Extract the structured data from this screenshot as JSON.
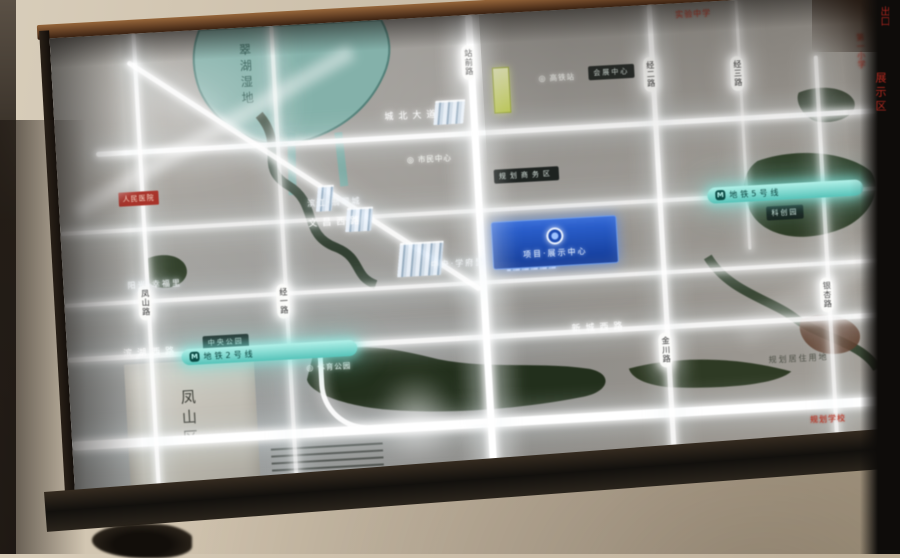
{
  "photo": {
    "description": "售楼处发光区位图灯箱照片",
    "wall_color": "#c8bba6",
    "frame_wood_color": "#6b4527"
  },
  "map": {
    "lake_label": "翠湖湿地",
    "district_label": "凤山区",
    "metro_lines": [
      {
        "icon": "M",
        "label": "地铁5号线"
      },
      {
        "icon": "M",
        "label": "地铁2号线"
      }
    ],
    "project_sign": {
      "logo": "",
      "name": "项目·展示中心"
    },
    "road_capsules": [
      "凤山路",
      "经一路",
      "站前路",
      "金川路",
      "经二路",
      "经三路",
      "银杏路"
    ],
    "road_names": [
      "文昌西路",
      "城北大道",
      "新城西路",
      "滨湖西路"
    ],
    "poi_labels": [
      {
        "icon": "◎",
        "text": "高铁站"
      },
      {
        "icon": "◎",
        "text": "市民中心"
      },
      {
        "icon": "◎",
        "text": "体育公园"
      }
    ],
    "red_labels": [
      "人民医院",
      "实验中学",
      "第一小学",
      "规划学校"
    ],
    "dark_labels": [
      "中央公园",
      "规划商务区",
      "科创园",
      "会展中心"
    ],
    "glow_labels": [
      "滨江·翡翠城",
      "中央·学府里",
      "阳光·幸福里"
    ],
    "dark_text_label": "规划居住用地",
    "edge_signs": {
      "exit": "出口",
      "vertical": "展示区"
    },
    "colors": {
      "road_glow": "#ffffff",
      "water_teal": "#83b3ab",
      "water_dark": "#1c2a16",
      "metro_teal": "#7fd9d2",
      "project_blue": "#1f52b8",
      "red": "#b23227"
    }
  }
}
